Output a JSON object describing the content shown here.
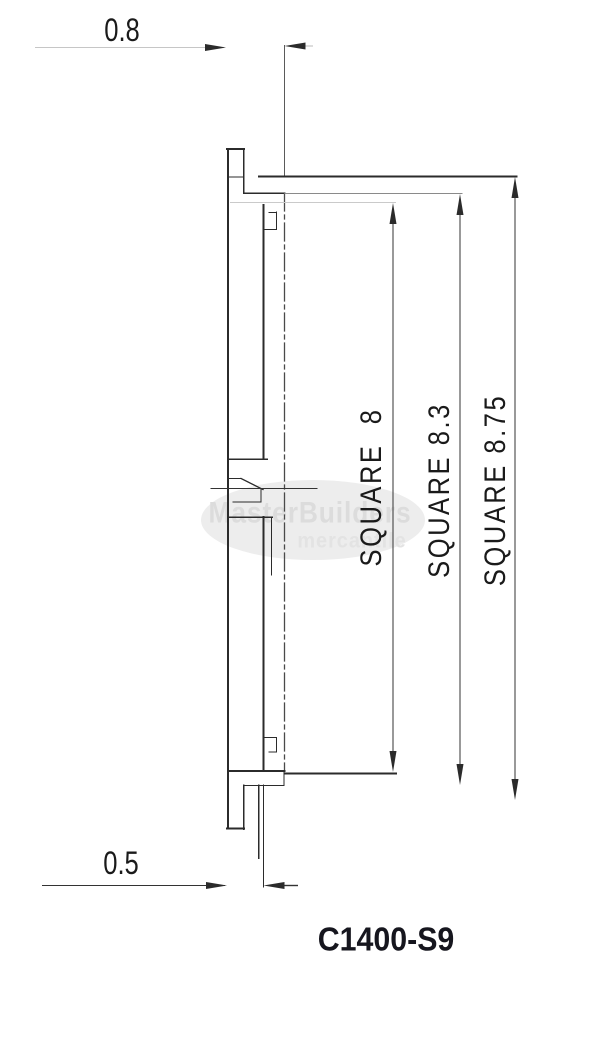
{
  "drawing": {
    "part_number": "C1400-S9",
    "dimensions": {
      "top_depth": "0.8",
      "bottom_depth": "0.5",
      "square_dims": [
        {
          "label": "SQUARE  8"
        },
        {
          "label": "SQUARE 8.3"
        },
        {
          "label": "SQUARE 8.75"
        }
      ]
    },
    "watermark": {
      "line1": "MasterBuilders",
      "line2": "mercantile"
    },
    "colors": {
      "background": "#ffffff",
      "line_dark": "#2b2b2b",
      "line_medium": "#8a8a8a",
      "line_faint": "#c6c6c6",
      "dim_line": "#333333",
      "text": "#1a1a1a",
      "part_number_text": "#16161e",
      "watermark_fill": "#ededed",
      "watermark_text": "#dcdcdc"
    }
  }
}
